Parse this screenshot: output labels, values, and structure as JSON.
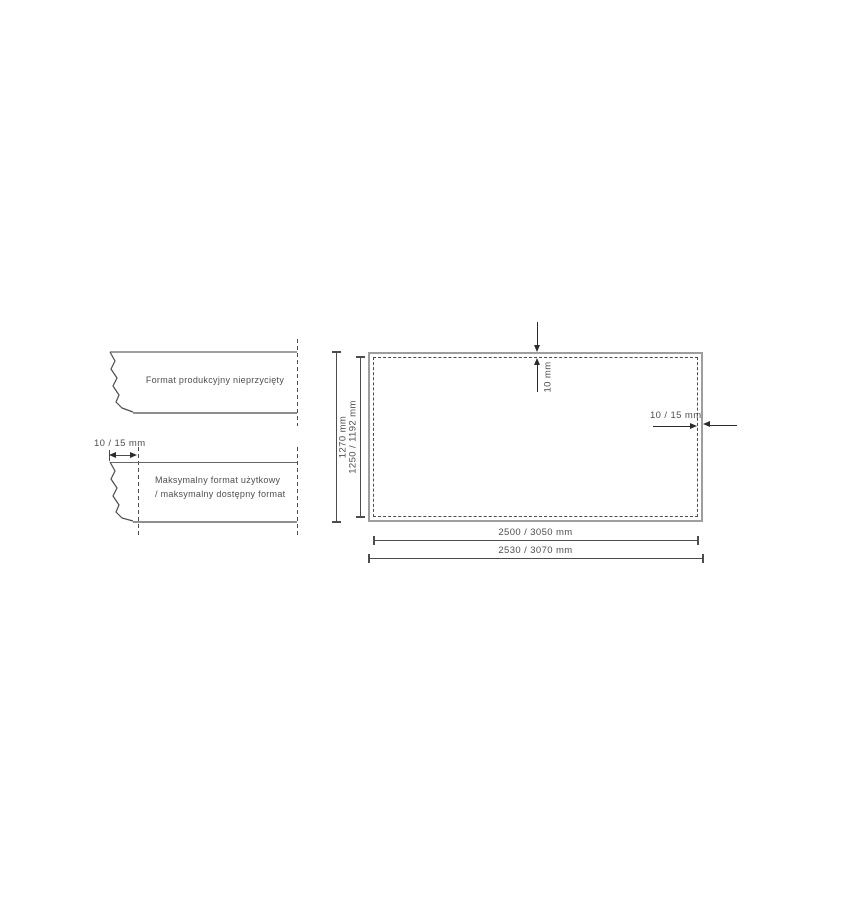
{
  "legend": {
    "uncut_label": "Format produkcyjny nieprzycięty",
    "usable_label_line1": "Maksymalny format użytkowy",
    "usable_label_line2": "/ maksymalny dostępny format",
    "edge_trim_dim": "10 / 15 mm"
  },
  "drawing": {
    "outer_height": "1270 mm",
    "inner_height": "1250 / 1192 mm",
    "top_trim": "10 mm",
    "side_trim": "10 / 15 mm",
    "inner_width": "2500 / 3050 mm",
    "outer_width": "2530 / 3070 mm"
  },
  "colors": {
    "edge_gray": "#9e9e9e",
    "line_dark": "#4d4d4d",
    "arrow_dark": "#2b2b2b",
    "text": "#4f4f4f",
    "background": "#ffffff"
  }
}
